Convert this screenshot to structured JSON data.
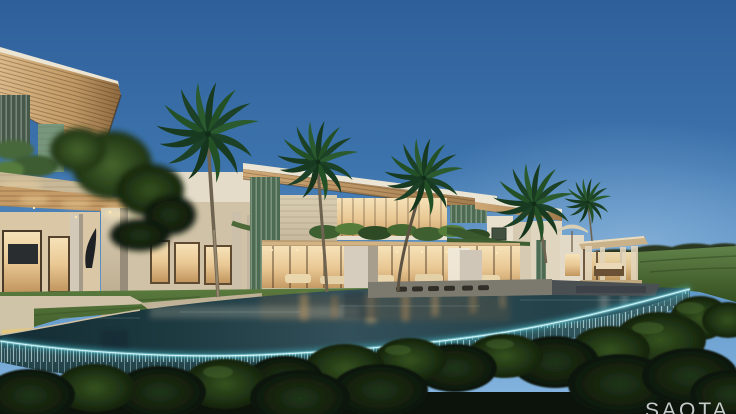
{
  "meta": {
    "type": "architectural-rendering",
    "alt": "Dusk rendering of a modern tropical villa with layered timber roofs, palm trees, warmly lit interiors, lawns and a curved infinity pool with an illuminated waterfall edge above a dark tree canopy",
    "width": 736,
    "height": 414
  },
  "watermark": {
    "text": "SAOTA"
  },
  "palette": {
    "sky_top": "#2f5f9a",
    "sky_horizon": "#8ab8e2",
    "roof_timber": "#c09a66",
    "fascia_white": "#ece5d3",
    "stone": "#d3c5a8",
    "interior_glow": "#f2d6a0",
    "green_screen": "#5d7d64",
    "lawn": "#55743c",
    "field_grass": "#4f6f3a",
    "treeline": "#2a3822",
    "water_dark": "#16313a",
    "water_mid": "#2e4c55",
    "edge_glow": "#aff0f6",
    "waterfall": "#9fd4da",
    "canopy_dark": "#101b0b",
    "canopy_mid": "#33501f",
    "palm_frond": "#1d4423",
    "palm_trunk": "#8a7a60"
  }
}
